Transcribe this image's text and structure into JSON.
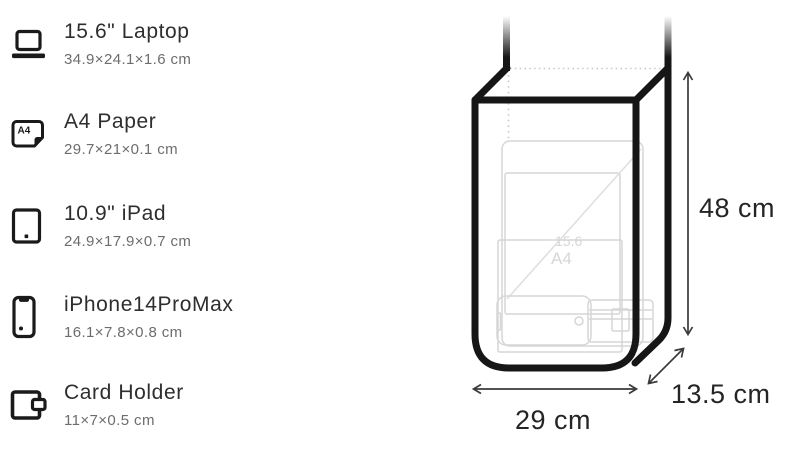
{
  "page": {
    "background": "#ffffff",
    "type": "product-capacity-diagram"
  },
  "items": [
    {
      "name": "15.6\" Laptop",
      "dims": "34.9×24.1×1.6 cm",
      "icon": "laptop-icon"
    },
    {
      "name": "A4 Paper",
      "dims": "29.7×21×0.1 cm",
      "icon": "a4-paper-icon"
    },
    {
      "name": "10.9\" iPad",
      "dims": "24.9×17.9×0.7 cm",
      "icon": "tablet-icon"
    },
    {
      "name": "iPhone14ProMax",
      "dims": "16.1×7.8×0.8 cm",
      "icon": "phone-icon"
    },
    {
      "name": "Card Holder",
      "dims": "11×7×0.5 cm",
      "icon": "wallet-icon"
    }
  ],
  "icons": {
    "a4_badge": "A4"
  },
  "diagram": {
    "height_label": "48 cm",
    "width_label": "29 cm",
    "depth_label": "13.5 cm",
    "ghost_labels": {
      "a4_sheet": "A4",
      "laptop_diagonal": "15.6"
    },
    "colors": {
      "bag_outline": "#161616",
      "ghost_items": "#d6d6d6",
      "dotted_hidden_edges": "#c9c9c9",
      "dimension_arrows": "#3a3a3a",
      "dimension_text": "#252525"
    }
  }
}
